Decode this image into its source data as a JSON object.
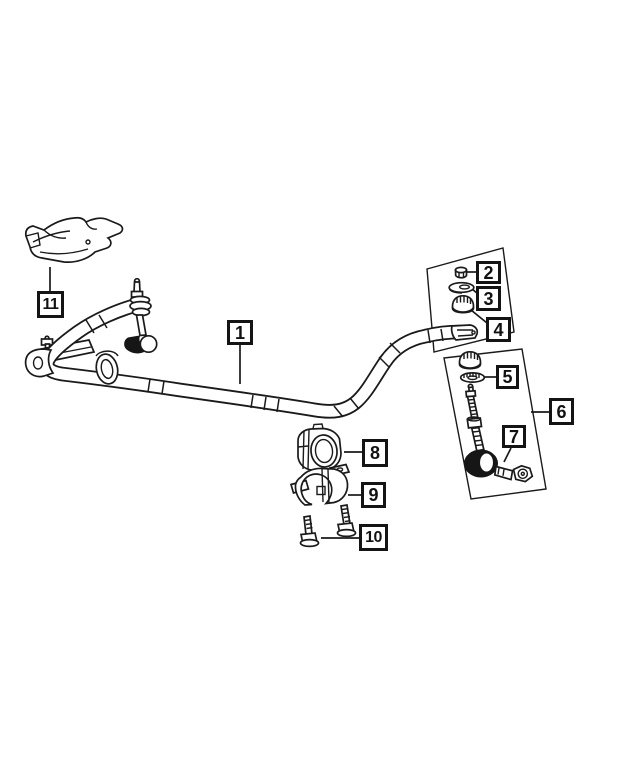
{
  "diagram": {
    "background": "#ffffff",
    "line_color": "#1a1a1a",
    "callouts": [
      {
        "label": "1"
      },
      {
        "label": "2"
      },
      {
        "label": "3"
      },
      {
        "label": "4"
      },
      {
        "label": "5"
      },
      {
        "label": "6"
      },
      {
        "label": "7"
      },
      {
        "label": "8"
      },
      {
        "label": "9"
      },
      {
        "label": "10"
      },
      {
        "label": "11"
      }
    ]
  }
}
